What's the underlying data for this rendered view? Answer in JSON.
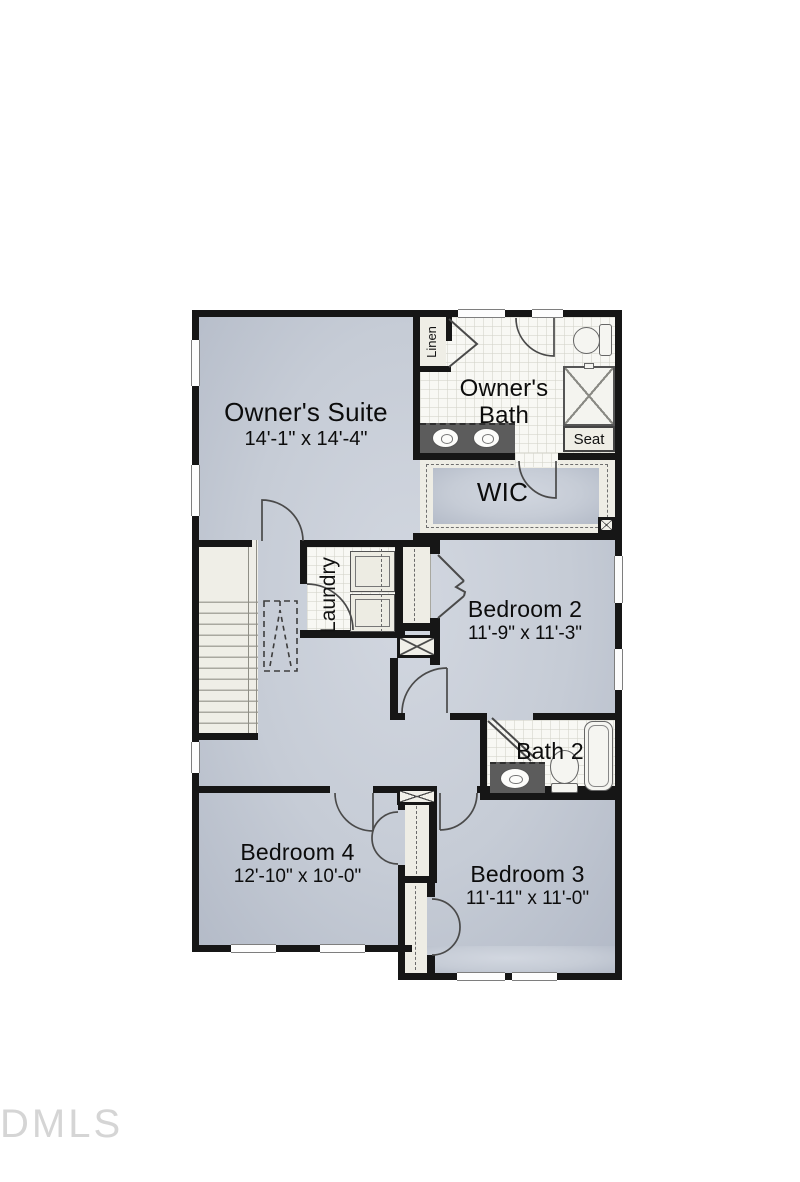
{
  "plan": {
    "title": "second floor plan",
    "watermark": "DMLS",
    "rooms": {
      "owners_suite": {
        "name": "Owner's Suite",
        "dims": "14'-1\" x 14'-4\""
      },
      "owners_bath": {
        "name_line1": "Owner's",
        "name_line2": "Bath"
      },
      "wic": {
        "name": "WIC"
      },
      "linen": {
        "name": "Linen"
      },
      "shower_seat": {
        "name": "Seat"
      },
      "laundry": {
        "name": "Laundry"
      },
      "bedroom2": {
        "name": "Bedroom 2",
        "dims": "11'-9\" x 11'-3\""
      },
      "bath2": {
        "name": "Bath 2"
      },
      "bedroom4": {
        "name": "Bedroom 4",
        "dims": "12'-10\" x 10'-0\""
      },
      "bedroom3": {
        "name": "Bedroom 3",
        "dims": "11'-11\" x 11'-0\""
      }
    },
    "colors": {
      "wall": "#161616",
      "floor": "#c6ccd6",
      "tile": "#f8f8f4",
      "cream": "#eeede5",
      "counter": "#5c5c5c"
    }
  }
}
